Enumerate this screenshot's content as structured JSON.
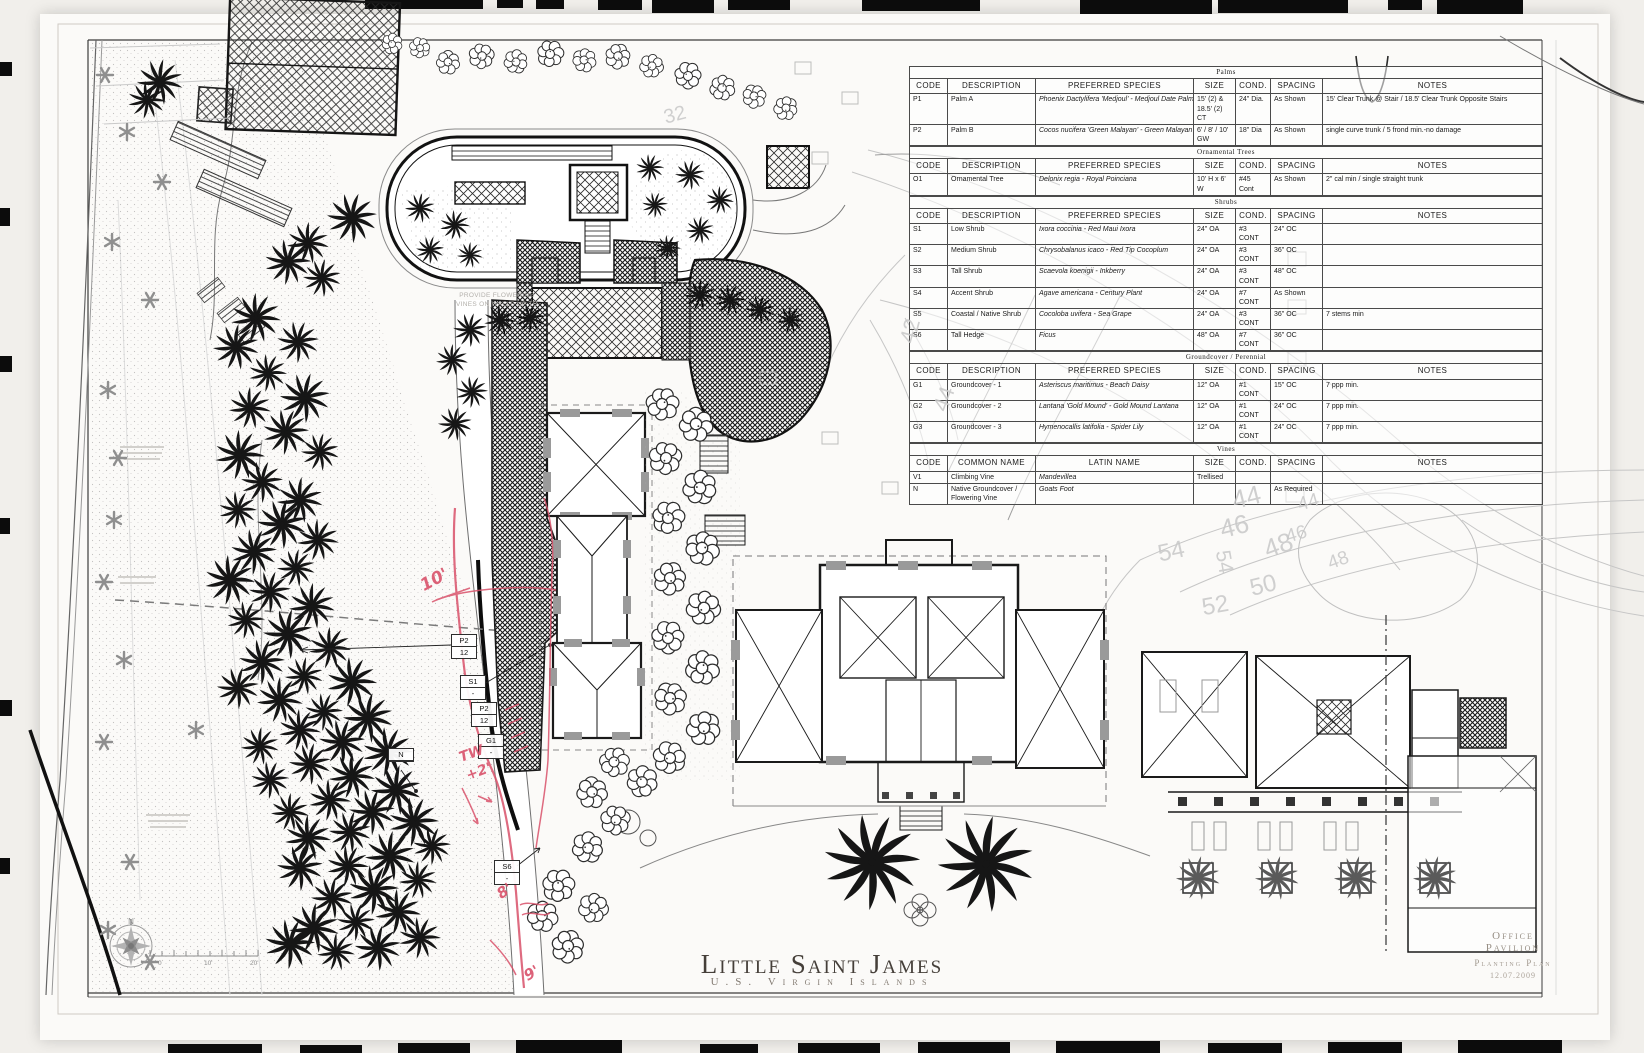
{
  "sheet": {
    "plan_title": "Little Saint James",
    "plan_subtitle": "U.S. Virgin Islands",
    "corner_block": {
      "line1": "Office",
      "line2": "Pavilion",
      "line3": "Planting Plan",
      "line4": "12.07.2009"
    },
    "note": {
      "line1": "PROVIDE FLOWERING",
      "line2": "VINES ON WALLS UP TO"
    },
    "compass_label": "N",
    "scale_labels": [
      "0",
      "10'",
      "20'"
    ]
  },
  "schedule": {
    "sections": [
      {
        "title": "Palms",
        "headers": [
          "CODE",
          "DESCRIPTION",
          "PREFERRED SPECIES",
          "SIZE",
          "COND.",
          "SPACING",
          "NOTES"
        ],
        "rows": [
          [
            "P1",
            "Palm A",
            "Phoenix Dactylifera 'Medjoul' - Medjoul Date Palm",
            "15' (2) & 18.5' (2) CT",
            "24\" Dia.",
            "As Shown",
            "15' Clear Trunk @ Stair / 18.5' Clear Trunk Opposite Stairs"
          ],
          [
            "P2",
            "Palm B",
            "Cocos nucifera 'Green Malayan' - Green Malayan Coco Palm",
            "6' / 8' / 10' GW",
            "18\" Dia",
            "As Shown",
            "single curve trunk / 5 frond min.-no damage"
          ]
        ]
      },
      {
        "title": "Ornamental Trees",
        "headers": [
          "CODE",
          "DESCRIPTION",
          "PREFERRED SPECIES",
          "SIZE",
          "COND.",
          "SPACING",
          "NOTES"
        ],
        "rows": [
          [
            "O1",
            "Ornamental Tree",
            "Delonix regia - Royal Poinciana",
            "10' H x 6' W",
            "#45 Cont",
            "As Shown",
            "2\" cal min / single straight trunk"
          ]
        ]
      },
      {
        "title": "Shrubs",
        "headers": [
          "CODE",
          "DESCRIPTION",
          "PREFERRED SPECIES",
          "SIZE",
          "COND.",
          "SPACING",
          "NOTES"
        ],
        "rows": [
          [
            "S1",
            "Low Shrub",
            "Ixora coccinia - Red Maui Ixora",
            "24\" OA",
            "#3 CONT",
            "24\" OC",
            ""
          ],
          [
            "S2",
            "Medium Shrub",
            "Chrysobalanus icaco - Red Tip Cocoplum",
            "24\" OA",
            "#3 CONT",
            "36\" OC",
            ""
          ],
          [
            "S3",
            "Tall Shrub",
            "Scaevola koenigii - Inkberry",
            "24\" OA",
            "#3 CONT",
            "48\" OC",
            ""
          ],
          [
            "S4",
            "Accent Shrub",
            "Agave americana - Century Plant",
            "24\" OA",
            "#7 CONT",
            "As Shown",
            ""
          ],
          [
            "S5",
            "Coastal / Native Shrub",
            "Cocoloba uvifera - Sea Grape",
            "24\" OA",
            "#3 CONT",
            "36\" OC",
            "7 stems min"
          ],
          [
            "S6",
            "Tall Hedge",
            "Ficus",
            "48\" OA",
            "#7 CONT",
            "36\" OC",
            ""
          ]
        ]
      },
      {
        "title": "Groundcover / Perennial",
        "headers": [
          "CODE",
          "DESCRIPTION",
          "PREFERRED SPECIES",
          "SIZE",
          "COND.",
          "SPACING",
          "NOTES"
        ],
        "rows": [
          [
            "G1",
            "Groundcover - 1",
            "Asteriscus maritimus - Beach Daisy",
            "12\" OA",
            "#1 CONT",
            "15\" OC",
            "7 ppp min."
          ],
          [
            "G2",
            "Groundcover - 2",
            "Lantana 'Gold Mound' - Gold Mound Lantana",
            "12\" OA",
            "#1 CONT",
            "24\" OC",
            "7 ppp min."
          ],
          [
            "G3",
            "Groundcover - 3",
            "Hymenocallis latifolia - Spider Lily",
            "12\" OA",
            "#1 CONT",
            "24\" OC",
            "7 ppp min."
          ]
        ]
      },
      {
        "title": "Vines",
        "headers": [
          "CODE",
          "COMMON NAME",
          "LATIN NAME",
          "SIZE",
          "COND.",
          "SPACING",
          "NOTES"
        ],
        "rows": [
          [
            "V1",
            "Climbing Vine",
            "Mandevillea",
            "Trellised",
            "",
            "",
            ""
          ],
          [
            "N",
            "Native Groundcover / Flowering Vine",
            "Goats Foot",
            "",
            "",
            "As Required",
            ""
          ]
        ]
      }
    ]
  },
  "callouts": [
    {
      "top": "P2",
      "bottom": "12",
      "x": 451,
      "y": 634
    },
    {
      "top": "S1",
      "bottom": "-",
      "x": 460,
      "y": 675
    },
    {
      "top": "P2",
      "bottom": "12",
      "x": 471,
      "y": 702
    },
    {
      "top": "G1",
      "bottom": "-",
      "x": 478,
      "y": 734
    },
    {
      "top": "N",
      "bottom": "",
      "x": 388,
      "y": 748
    },
    {
      "top": "S6",
      "bottom": "-",
      "x": 494,
      "y": 860
    }
  ],
  "red_markups": [
    {
      "text": "10'",
      "x": 420,
      "y": 570,
      "rot": -28,
      "size": 17
    },
    {
      "text": "TW",
      "x": 459,
      "y": 746,
      "rot": -20,
      "size": 14
    },
    {
      "text": "+2'",
      "x": 466,
      "y": 764,
      "rot": -20,
      "size": 14
    },
    {
      "text": "8'",
      "x": 497,
      "y": 882,
      "rot": -35,
      "size": 15
    },
    {
      "text": "9'",
      "x": 524,
      "y": 964,
      "rot": -30,
      "size": 15
    }
  ],
  "contour_labels": [
    {
      "t": "32",
      "x": 664,
      "y": 104,
      "r": -15,
      "s": 20
    },
    {
      "t": "42",
      "x": 898,
      "y": 318,
      "r": -75,
      "s": 22
    },
    {
      "t": "44",
      "x": 932,
      "y": 386,
      "r": -70,
      "s": 22
    },
    {
      "t": "44",
      "x": 1232,
      "y": 482,
      "r": -14,
      "s": 26
    },
    {
      "t": "46",
      "x": 1220,
      "y": 511,
      "r": -14,
      "s": 26
    },
    {
      "t": "48",
      "x": 1264,
      "y": 530,
      "r": -20,
      "s": 26
    },
    {
      "t": "50",
      "x": 1250,
      "y": 572,
      "r": -14,
      "s": 24
    },
    {
      "t": "52",
      "x": 1202,
      "y": 592,
      "r": -10,
      "s": 24
    },
    {
      "t": "54",
      "x": 1158,
      "y": 538,
      "r": -12,
      "s": 24
    },
    {
      "t": "44",
      "x": 1298,
      "y": 492,
      "r": -16,
      "s": 19
    },
    {
      "t": "46",
      "x": 1286,
      "y": 524,
      "r": -16,
      "s": 19
    },
    {
      "t": "48",
      "x": 1328,
      "y": 550,
      "r": -20,
      "s": 19
    },
    {
      "t": "54",
      "x": 1212,
      "y": 550,
      "r": 80,
      "s": 21
    }
  ]
}
